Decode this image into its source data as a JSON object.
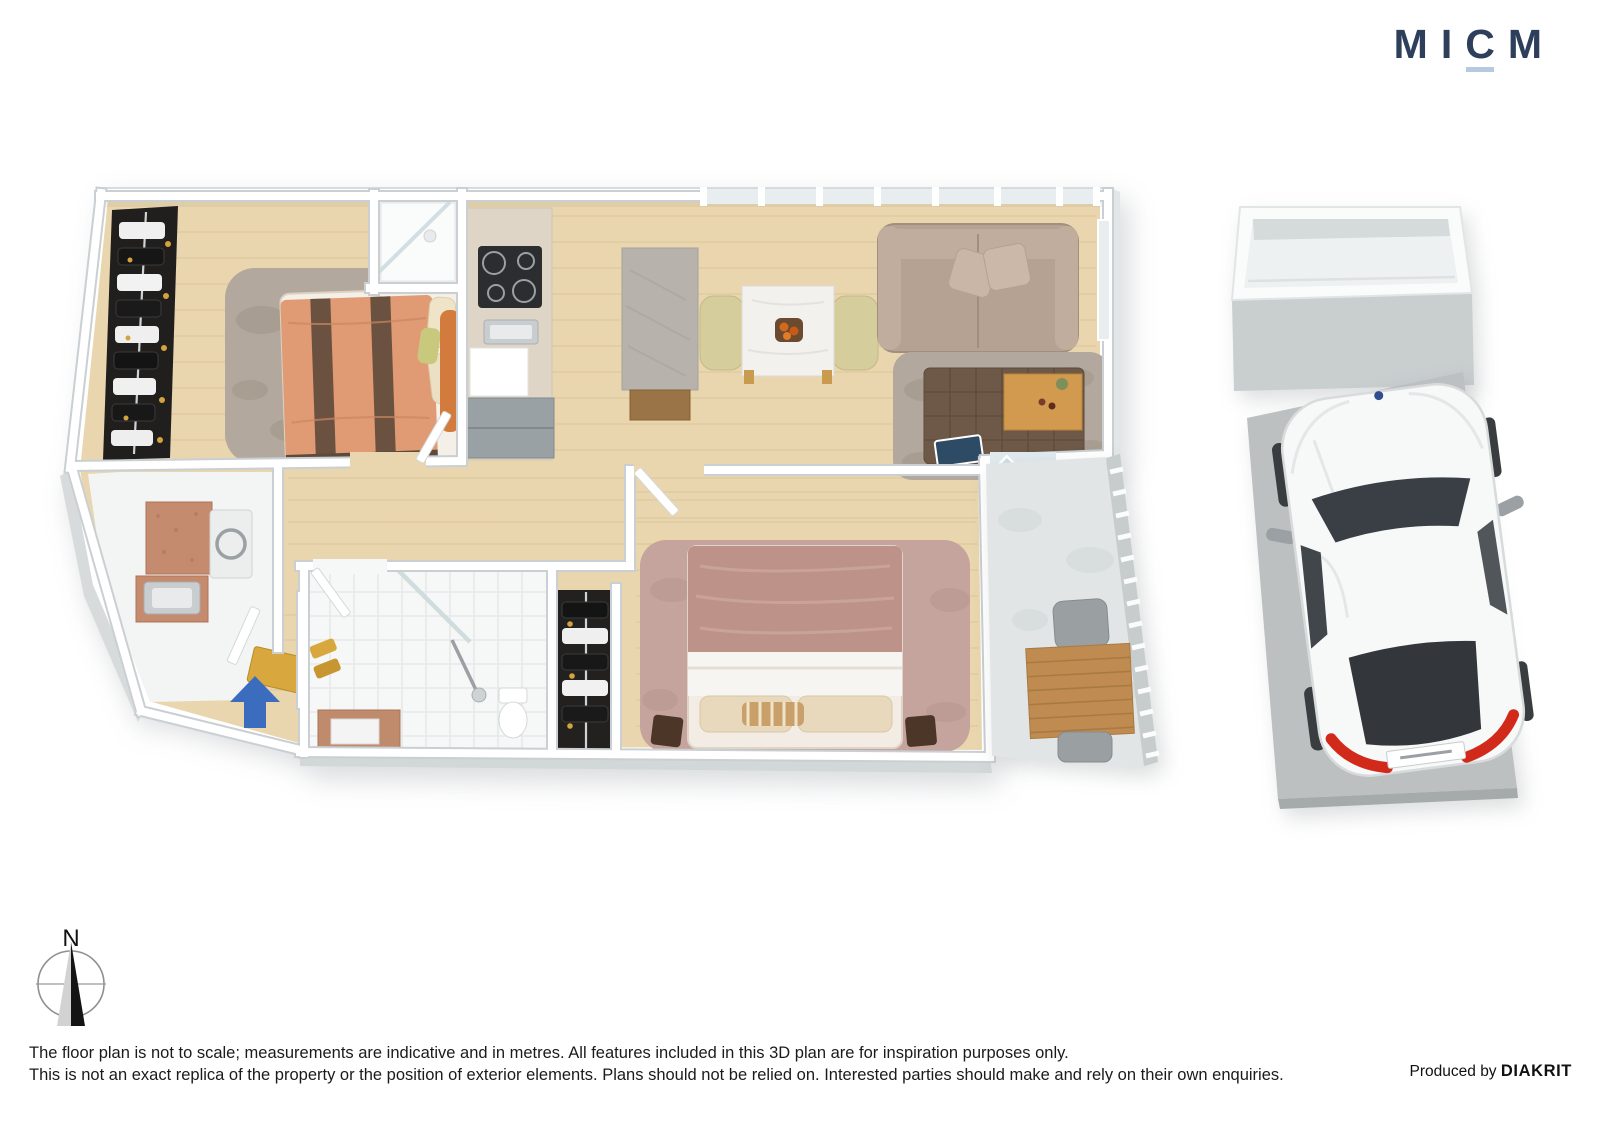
{
  "logo": {
    "letters": [
      "M",
      "I",
      "C",
      "M"
    ],
    "underlined_letter": "C",
    "color": "#2e3f5c",
    "underline_color": "#b7c9de"
  },
  "compass": {
    "north_label": "N"
  },
  "footer": {
    "disclaimer_line1": "The floor plan is not to scale; measurements are indicative and in metres. All features included in this 3D plan are for inspiration purposes only.",
    "disclaimer_line2": "This is not an exact replica of the property or the position of exterior elements. Plans should not be relied on. Interested parties should make and rely on their own enquiries.",
    "credit_prefix": "Produced by ",
    "credit_brand": "DIAKRIT"
  },
  "palette": {
    "logo_navy": "#2e3f5c",
    "logo_underline": "#b7c9de",
    "entry_arrow": "#3c6cbe",
    "wall_white": "#ffffff",
    "wall_edge": "#c9cfd2",
    "wood_floor": "#e9d6ae",
    "plank_line": "#d9c296",
    "rug_gray": "#b2a89d",
    "bed1_duvet": "#e09a74",
    "bed1_stripe": "#6a5140",
    "headboard_orange": "#d27b3c",
    "sofa_taupe": "#b5a293",
    "ottoman_brown": "#6e5948",
    "tray_wood": "#d29a4e",
    "bed2_duvet": "#bd9289",
    "rug_pink": "#c4a49c",
    "tile_terracotta": "#c58b6e",
    "balcony_floor": "#e1e5e6",
    "deck_table_wood": "#c08b50",
    "slab_gray": "#bcc0c0",
    "car_white": "#f7f8f8",
    "car_glass": "#3a3f45",
    "taillight_red": "#d22a1a",
    "mat_gold": "#d8a83e",
    "text_dark": "#1b1b1b"
  }
}
